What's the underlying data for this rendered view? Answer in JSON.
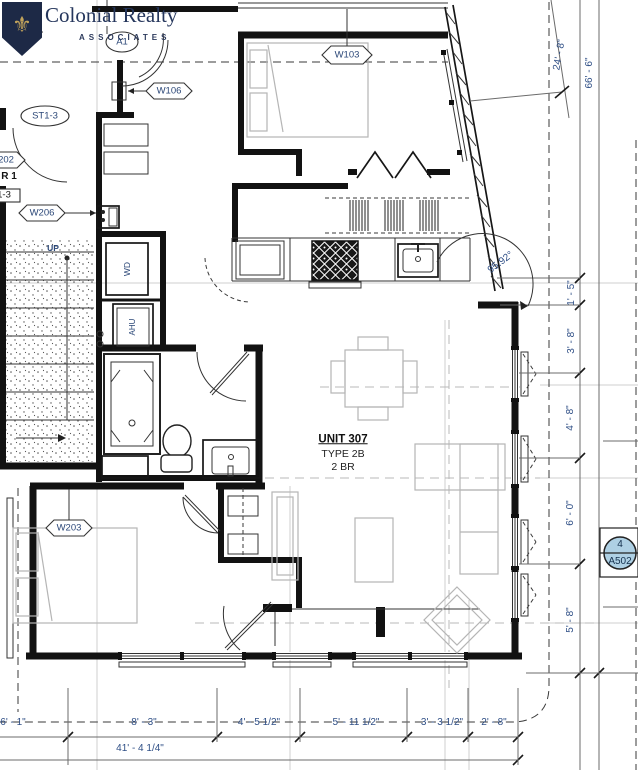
{
  "logo": {
    "name": "Colonial Realty",
    "subtitle": "ASSOCIATES"
  },
  "unit": {
    "number": "UNIT 307",
    "type": "TYPE 2B",
    "beds": "2 BR"
  },
  "tags": {
    "a1": "A1",
    "st13": "ST1-3",
    "w106": "W106",
    "w103": "W103",
    "w206": "W206",
    "w203": "W203",
    "w202_partial": "202",
    "stair_partial": "R 1",
    "st_partial": "1-3"
  },
  "notes": {
    "up": "UP",
    "wd": "WD",
    "ahu": "AHU"
  },
  "angle": "95.92°",
  "dimensions": {
    "d24_8": "24' - 8\"",
    "d66_6": "66' - 6\"",
    "d1_5": "1' - 5\"",
    "d3_8": "3' - 8\"",
    "d4_8": "4' - 8\"",
    "d6_0": "6' - 0\"",
    "d5_8": "5' - 8\"",
    "d6_1": "6' - 1\"",
    "d8_3": "8' - 3\"",
    "d4_5h": "4' - 5 1/2\"",
    "d5_11h": "5' - 11 1/2\"",
    "d3_3h": "3' - 3 1/2\"",
    "d2_8": "2' - 8\"",
    "total": "41' - 4 1/4\""
  },
  "section_marker": {
    "number": "4",
    "sheet": "A502"
  },
  "colors": {
    "annotation_blue": "#2f4f86",
    "marker_fill": "#aed0e4",
    "logo_navy": "#1d2946",
    "logo_gold": "#c2a35b",
    "furniture_gray": "#b5b5b5",
    "grid_gray": "#cfcfcf"
  }
}
